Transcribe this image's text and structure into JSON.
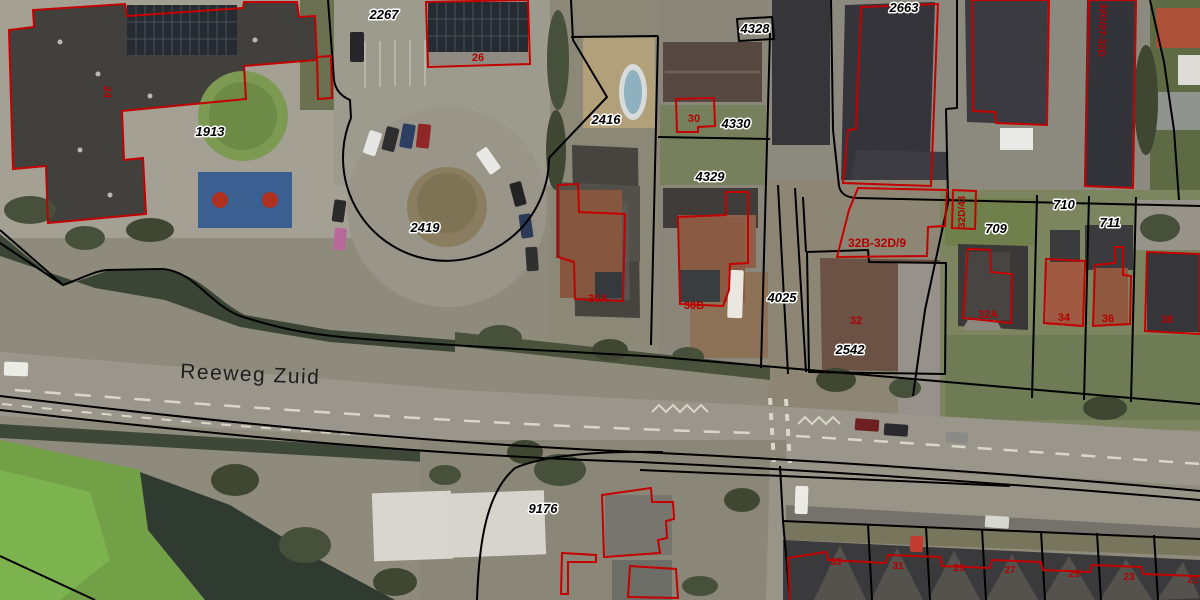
{
  "map": {
    "street_label": "Reeweg Zuid",
    "parcel_labels": [
      "2267",
      "1913",
      "2416",
      "2419",
      "4328",
      "4330",
      "4329",
      "4025",
      "2542",
      "2663",
      "709",
      "710",
      "711",
      "9176"
    ],
    "address_labels": [
      "26",
      "24",
      "30",
      "30A",
      "30B",
      "32",
      "32B-32D/9",
      "32D/43",
      "32C/27-32D",
      "32A",
      "34",
      "36",
      "38",
      "33",
      "31",
      "29",
      "27",
      "25",
      "23",
      "21"
    ],
    "colors": {
      "parcel_boundary": "#000000",
      "building_outline": "#c40000",
      "parcel_label_fill": "#000000",
      "parcel_label_halo": "#ffffff",
      "address_label_fill": "#b30000",
      "street_label_fill": "#1e1e1e"
    }
  }
}
